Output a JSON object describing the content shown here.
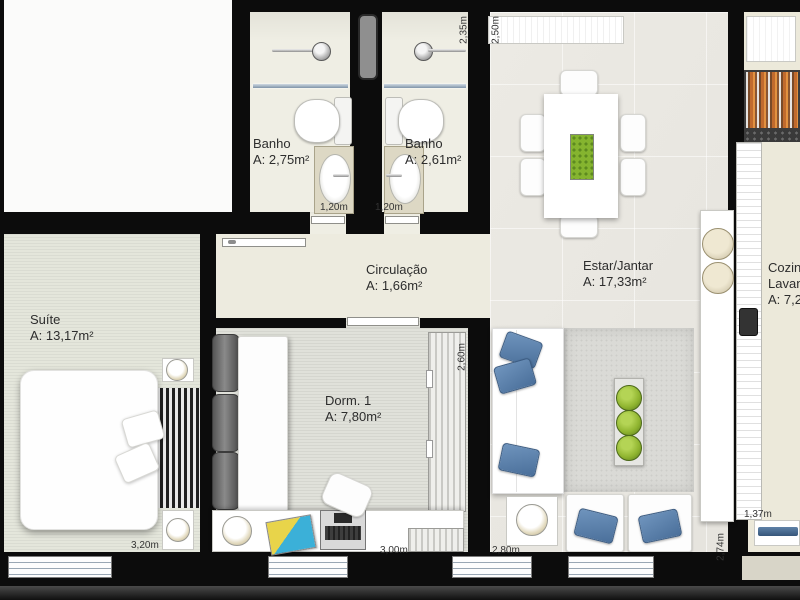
{
  "title": "Apartment floor plan",
  "rooms": {
    "banho1": {
      "label": "Banho",
      "area": "A: 2,75m²"
    },
    "banho2": {
      "label": "Banho",
      "area": "A: 2,61m²"
    },
    "circulacao": {
      "label": "Circulação",
      "area": "A: 1,66m²"
    },
    "estar": {
      "label": "Estar/Jantar",
      "area": "A: 17,33m²"
    },
    "suite": {
      "label": "Suíte",
      "area": "A: 13,17m²"
    },
    "dorm1": {
      "label": "Dorm. 1",
      "area": "A: 7,80m²"
    },
    "cozinha": {
      "line1": "Cozinha",
      "line2": "Lavanderia",
      "area": "A: 7,2"
    }
  },
  "dimensions": {
    "bath2_height": "2,35m",
    "estar_top": "2,50m",
    "bath1_counter": "1,20m",
    "bath2_counter": "1,20m",
    "suite_width": "3,20m",
    "dorm1_width": "3,00m",
    "estar_width": "2,80m",
    "dorm1_depth": "2,60m",
    "kitchen_depth": "2,74m",
    "kitchen_passage": "1,37m"
  },
  "colors": {
    "wall": "#0c0c0c",
    "pillow_blue": "#5b82ab",
    "plant_green": "#8fb42f",
    "grill_orange": "#c97c3a"
  }
}
